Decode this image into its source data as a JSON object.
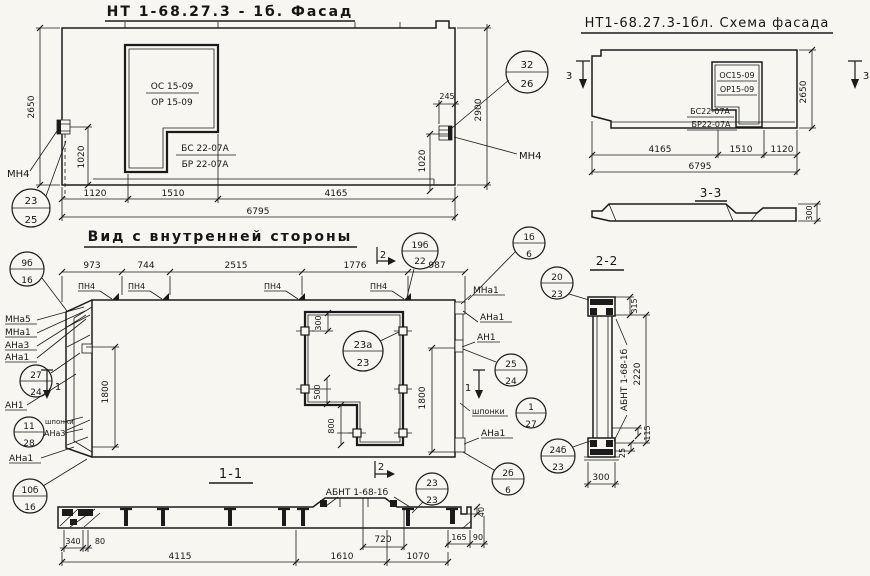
{
  "colors": {
    "paper": "#f7f6f1",
    "ink": "#1b1b1b"
  },
  "facade": {
    "title": "НТ 1-68.27.3 - 1б. Фасад",
    "win": [
      "ОС 15-09",
      "ОР 15-09",
      "БС 22-07А",
      "БР 22-07А"
    ],
    "dims": {
      "d2650": "2650",
      "d1020l": "1020",
      "d1020r": "1020",
      "d245": "245",
      "d2900": "2900",
      "b": [
        "1120",
        "1510",
        "4165"
      ],
      "total": "6795"
    },
    "mn4": "МН4",
    "c2325": {
      "t": "23",
      "b": "25"
    },
    "c3226": {
      "t": "32",
      "b": "26"
    }
  },
  "scheme": {
    "title": "НТ1-68.27.3-1бл. Схема фасада",
    "win": [
      "ОС15-09",
      "ОР15-09",
      "БС22-07А",
      "БР22-07А"
    ],
    "dims": {
      "d2650": "2650",
      "b": [
        "4165",
        "1510",
        "1120"
      ],
      "total": "6795"
    },
    "mark": "3",
    "s33": {
      "title": "3-3",
      "d300": "300"
    }
  },
  "view": {
    "title": "Вид с внутренней стороны",
    "top_dims": [
      "973",
      "744",
      "2515",
      "1776",
      "987"
    ],
    "pn4": "ПН4",
    "mark1": "1",
    "mark2": "2",
    "d1800": "1800",
    "d300": "300",
    "d500": "500",
    "d800": "800",
    "left_labels": [
      "МНа5",
      "МНа1",
      "АНа3",
      "АНа1"
    ],
    "an1": "АН1",
    "shponki": "шпонки",
    "ana3": "АНа3",
    "ana1": "АНа1",
    "right": {
      "mna1": "МНа1",
      "ana1": "АНа1",
      "an1": "АН1",
      "shponki": "шпонки",
      "ana1b": "АНа1"
    },
    "c9b": {
      "t": "9б",
      "b": "16"
    },
    "c19b": {
      "t": "19б",
      "b": "22"
    },
    "c1b": {
      "t": "1б",
      "b": "6"
    },
    "c23a": {
      "t": "23а",
      "b": "23"
    },
    "c27": {
      "t": "27",
      "b": "24"
    },
    "c11": {
      "t": "11",
      "b": "28"
    },
    "c10b": {
      "t": "10б",
      "b": "16"
    },
    "c25": {
      "t": "25",
      "b": "24"
    },
    "c1": {
      "t": "1",
      "b": "27"
    },
    "c2b": {
      "t": "2б",
      "b": "6"
    }
  },
  "sec11": {
    "title": "1-1",
    "abnt": "АБНТ 1-68-1б",
    "c2323": {
      "t": "23",
      "b": "23"
    },
    "d40": "40",
    "d165": "165",
    "d90": "90",
    "d720": "720",
    "d340": "340",
    "d80": "80",
    "bottom": [
      "4115",
      "1610",
      "1070"
    ]
  },
  "sec22": {
    "title": "2-2",
    "abnt": "АБНТ 1-68-1б",
    "d315": "315",
    "d2220": "2220",
    "d115": "115",
    "d25": "25",
    "d300": "300",
    "c2023": {
      "t": "20",
      "b": "23"
    },
    "c24b": {
      "t": "24б",
      "b": "23"
    }
  }
}
